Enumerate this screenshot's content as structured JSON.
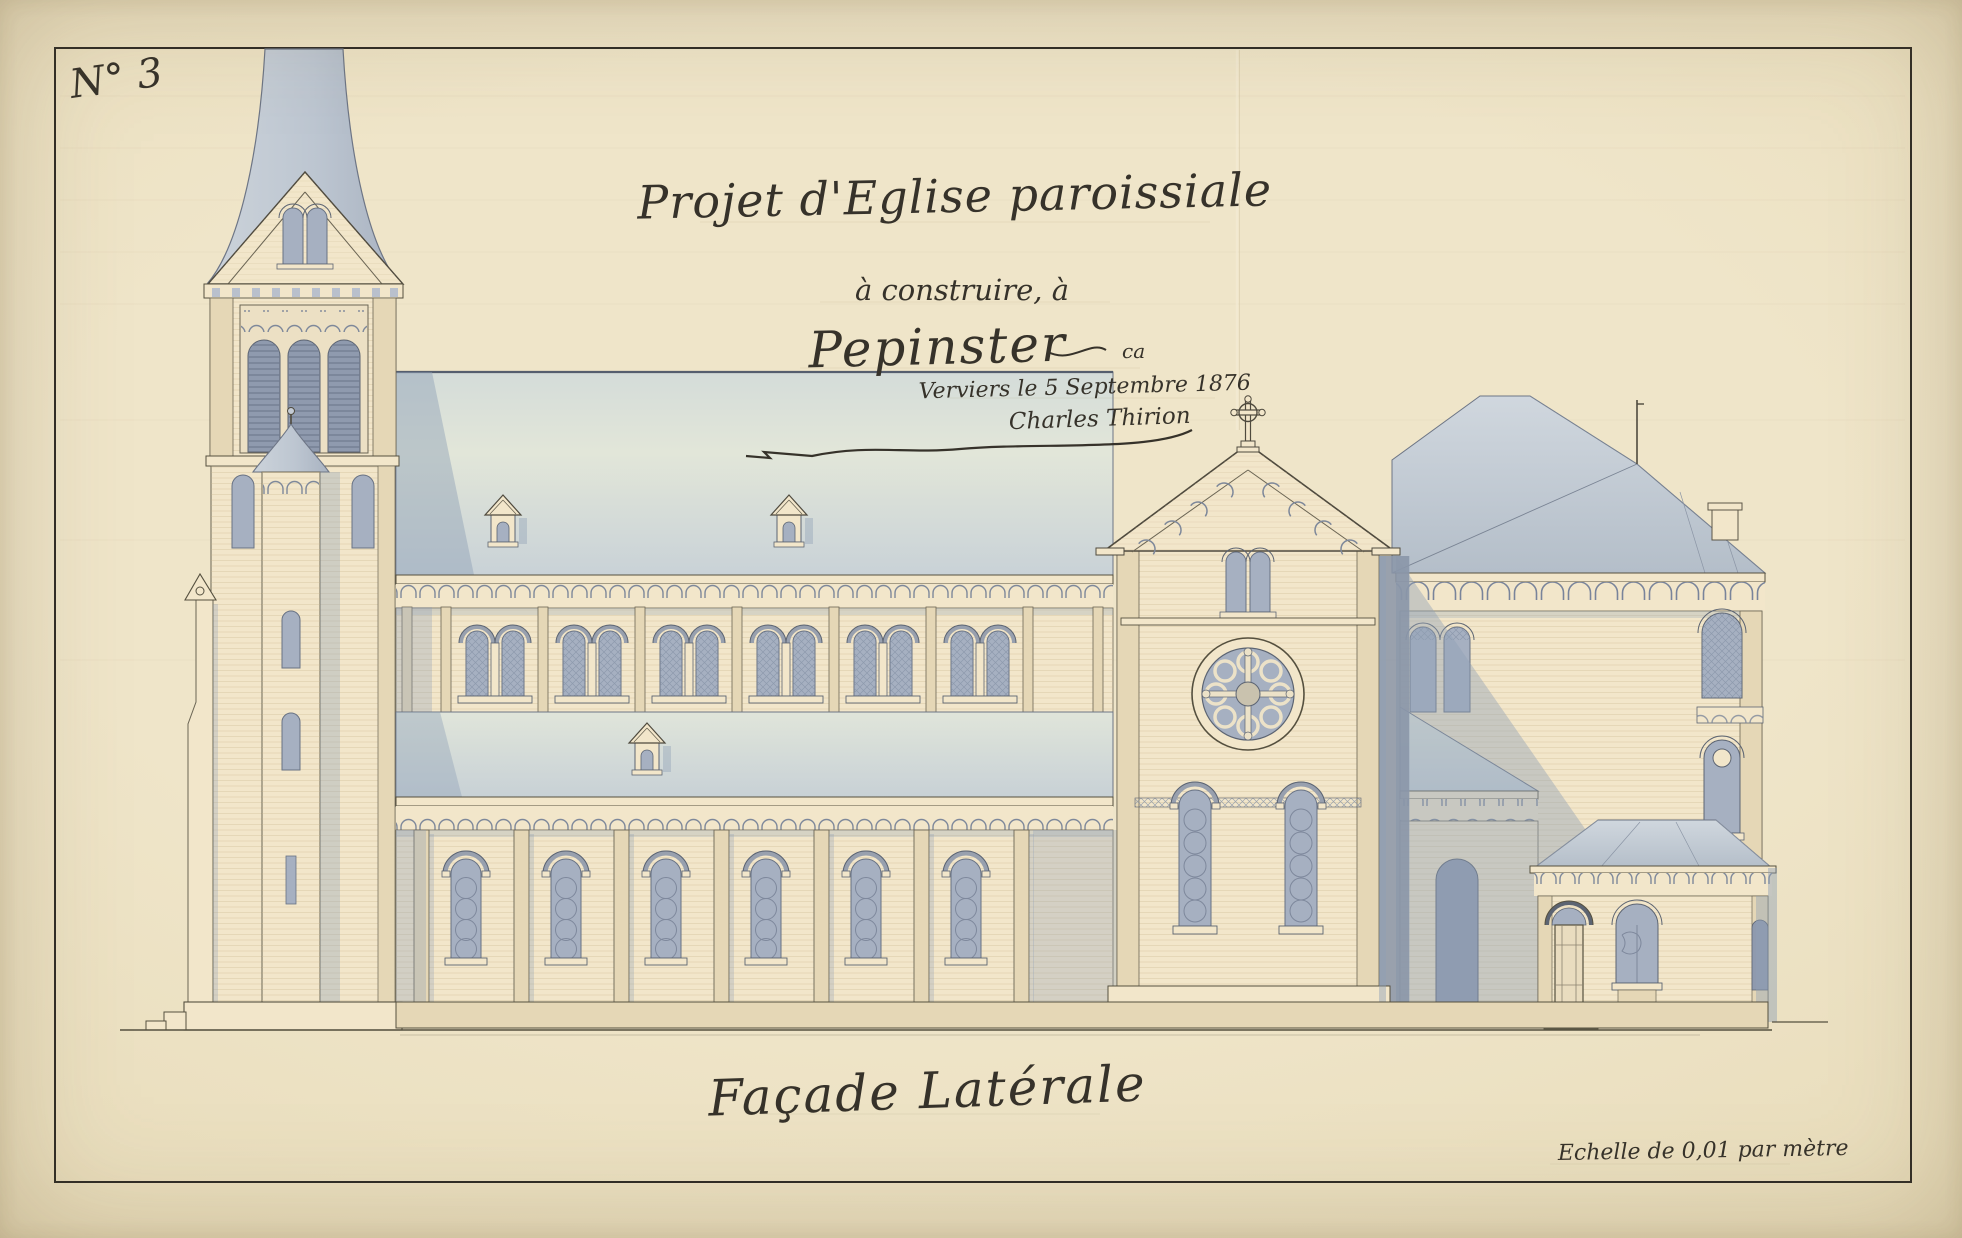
{
  "sheet": {
    "plan_number": "N° 3",
    "title": "Projet d'Eglise paroissiale",
    "subtitle": "à construire, à",
    "place": "Pepinster",
    "place_suffix": "ca",
    "date_line": "Verviers le 5 Septembre 1876",
    "signature": "Charles Thirion",
    "caption": "Façade Latérale",
    "scale_note": "Echelle de 0,01 par mètre"
  },
  "colors": {
    "paper": "#eadfc2",
    "ink": "#55503f",
    "ink_text": "#36322a",
    "wall": "#f2e6ca",
    "wall_shade": "#e5d7b6",
    "roof": "#c3cbd5",
    "roof_light": "#dde3d8",
    "glass": "#a6b0c1",
    "glass_dark": "#8f9aae",
    "shadow": "#8ea0b6",
    "frame": "#2f2c26",
    "pencil": "#a49570"
  }
}
